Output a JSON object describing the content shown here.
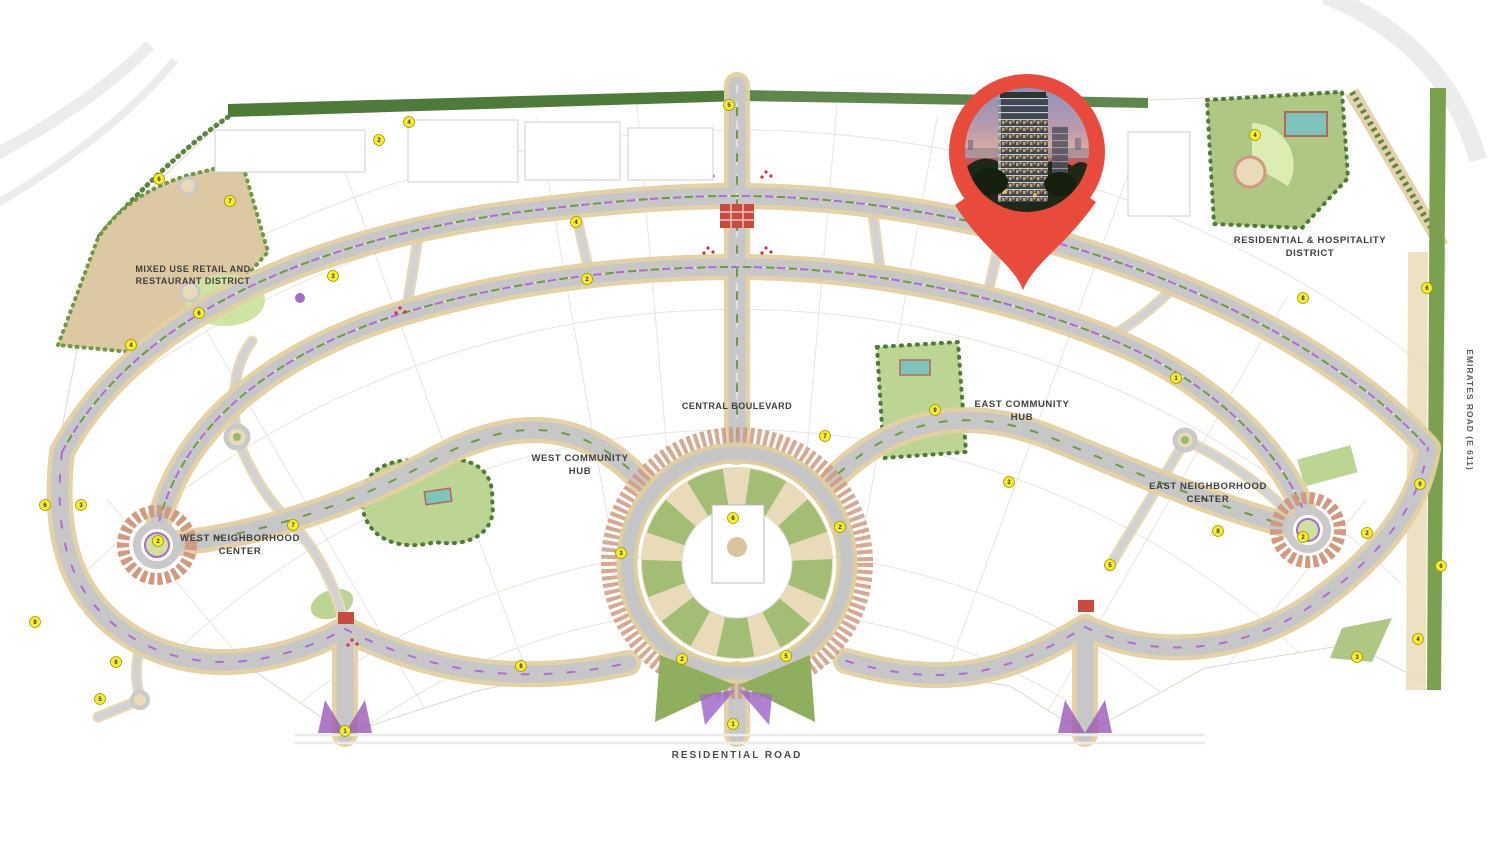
{
  "title": "Community Masterplan Map",
  "districts": [
    {
      "id": "mixed-use",
      "line1": "MIXED USE RETAIL AND",
      "line2": "RESTAURANT DISTRICT"
    },
    {
      "id": "central-boulevard",
      "line1": "CENTRAL BOULEVARD",
      "line2": ""
    },
    {
      "id": "west-community-hub",
      "line1": "WEST COMMUNITY",
      "line2": "HUB"
    },
    {
      "id": "east-community-hub",
      "line1": "EAST COMMUNITY",
      "line2": "HUB"
    },
    {
      "id": "west-neighborhood-center",
      "line1": "WEST NEIGHBORHOOD",
      "line2": "CENTER"
    },
    {
      "id": "east-neighborhood-center",
      "line1": "EAST NEIGHBORHOOD",
      "line2": "CENTER"
    },
    {
      "id": "residential-hospitality-district",
      "line1": "RESIDENTIAL & HOSPITALITY",
      "line2": "DISTRICT"
    },
    {
      "id": "residential-road",
      "line1": "RESIDENTIAL ROAD",
      "line2": ""
    },
    {
      "id": "emirates-road",
      "line1": "EMIRATES ROAD (E 611)",
      "line2": ""
    }
  ],
  "markers": [
    {
      "x": 409,
      "y": 122,
      "n": "4"
    },
    {
      "x": 379,
      "y": 140,
      "n": "2"
    },
    {
      "x": 159,
      "y": 179,
      "n": "6"
    },
    {
      "x": 230,
      "y": 201,
      "n": "7"
    },
    {
      "x": 333,
      "y": 276,
      "n": "3"
    },
    {
      "x": 199,
      "y": 313,
      "n": "6"
    },
    {
      "x": 131,
      "y": 345,
      "n": "4"
    },
    {
      "x": 45,
      "y": 505,
      "n": "6"
    },
    {
      "x": 81,
      "y": 505,
      "n": "3"
    },
    {
      "x": 293,
      "y": 525,
      "n": "7"
    },
    {
      "x": 158,
      "y": 541,
      "n": "2"
    },
    {
      "x": 35,
      "y": 622,
      "n": "8"
    },
    {
      "x": 116,
      "y": 662,
      "n": "6"
    },
    {
      "x": 100,
      "y": 699,
      "n": "5"
    },
    {
      "x": 345,
      "y": 731,
      "n": "1"
    },
    {
      "x": 521,
      "y": 666,
      "n": "8"
    },
    {
      "x": 682,
      "y": 659,
      "n": "2"
    },
    {
      "x": 786,
      "y": 656,
      "n": "5"
    },
    {
      "x": 733,
      "y": 724,
      "n": "1"
    },
    {
      "x": 733,
      "y": 518,
      "n": "6"
    },
    {
      "x": 825,
      "y": 436,
      "n": "7"
    },
    {
      "x": 840,
      "y": 527,
      "n": "2"
    },
    {
      "x": 621,
      "y": 553,
      "n": "3"
    },
    {
      "x": 729,
      "y": 105,
      "n": "5"
    },
    {
      "x": 576,
      "y": 222,
      "n": "4"
    },
    {
      "x": 587,
      "y": 279,
      "n": "2"
    },
    {
      "x": 935,
      "y": 410,
      "n": "9"
    },
    {
      "x": 1009,
      "y": 482,
      "n": "2"
    },
    {
      "x": 1110,
      "y": 565,
      "n": "5"
    },
    {
      "x": 1218,
      "y": 531,
      "n": "8"
    },
    {
      "x": 1303,
      "y": 537,
      "n": "2"
    },
    {
      "x": 1367,
      "y": 533,
      "n": "2"
    },
    {
      "x": 1420,
      "y": 484,
      "n": "6"
    },
    {
      "x": 1441,
      "y": 566,
      "n": "6"
    },
    {
      "x": 1418,
      "y": 639,
      "n": "4"
    },
    {
      "x": 1357,
      "y": 657,
      "n": "3"
    },
    {
      "x": 1303,
      "y": 298,
      "n": "8"
    },
    {
      "x": 1427,
      "y": 288,
      "n": "6"
    },
    {
      "x": 1255,
      "y": 135,
      "n": "4"
    },
    {
      "x": 1176,
      "y": 378,
      "n": "1"
    }
  ],
  "colors": {
    "pin_red": "#e84b3c",
    "road_gray": "#c7c7c7",
    "road_casing": "#e3d0a2",
    "park_green": "#bcd494",
    "lawn_green": "#d9e9b0",
    "tree_green": "#4f7a38",
    "strip_green": "#4e7a3a",
    "landscape_tan": "#dcc8a2",
    "ring_brown": "#cf9a80",
    "accent_purple": "#a86cc8",
    "pool_teal": "#7ec4bc",
    "marker_yellow": "#f7ec2e",
    "label_dark": "#3f3f3f"
  }
}
